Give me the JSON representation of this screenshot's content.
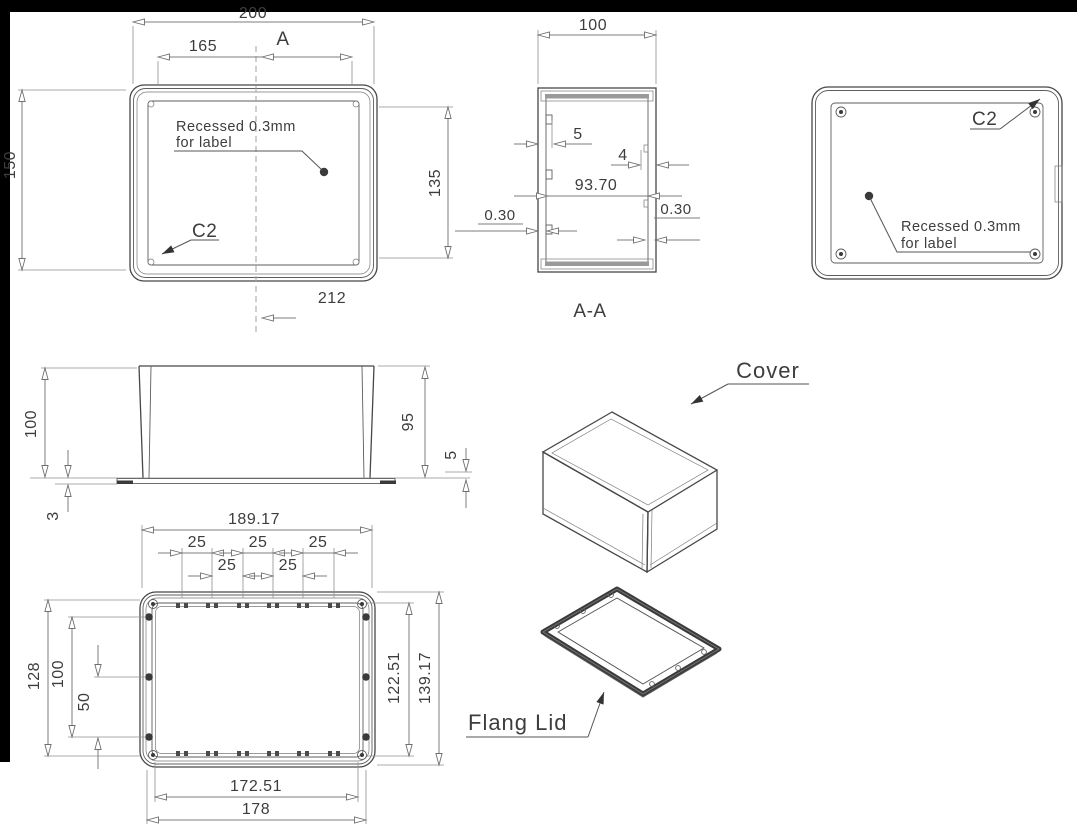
{
  "drawing": {
    "top_view": {
      "dim_200": "200",
      "dim_165": "165",
      "section_label": "A",
      "dim_150": "150",
      "dim_135": "135",
      "dim_212": "212",
      "chamfer_label": "C2",
      "note_line1": "Recessed 0.3mm",
      "note_line2": "for label"
    },
    "section_view": {
      "title": "A-A",
      "dim_100": "100",
      "dim_5": "5",
      "dim_4": "4",
      "dim_93_70": "93.70",
      "dim_030_left": "0.30",
      "dim_030_right": "0.30"
    },
    "back_view": {
      "chamfer_label": "C2",
      "note_line1": "Recessed 0.3mm",
      "note_line2": "for label"
    },
    "side_view": {
      "dim_100": "100",
      "dim_3": "3",
      "dim_95": "95",
      "dim_5": "5"
    },
    "bottom_view": {
      "dim_overall": "189.17",
      "pitch_row1": [
        "25",
        "25",
        "25"
      ],
      "pitch_row2": [
        "25",
        "25"
      ],
      "dim_128": "128",
      "dim_100": "100",
      "dim_50": "50",
      "dim_122_51": "122.51",
      "dim_139_17": "139.17",
      "dim_172_51": "172.51",
      "dim_178": "178"
    },
    "iso_cover": {
      "label": "Cover"
    },
    "iso_lid": {
      "label": "Flang Lid"
    }
  }
}
